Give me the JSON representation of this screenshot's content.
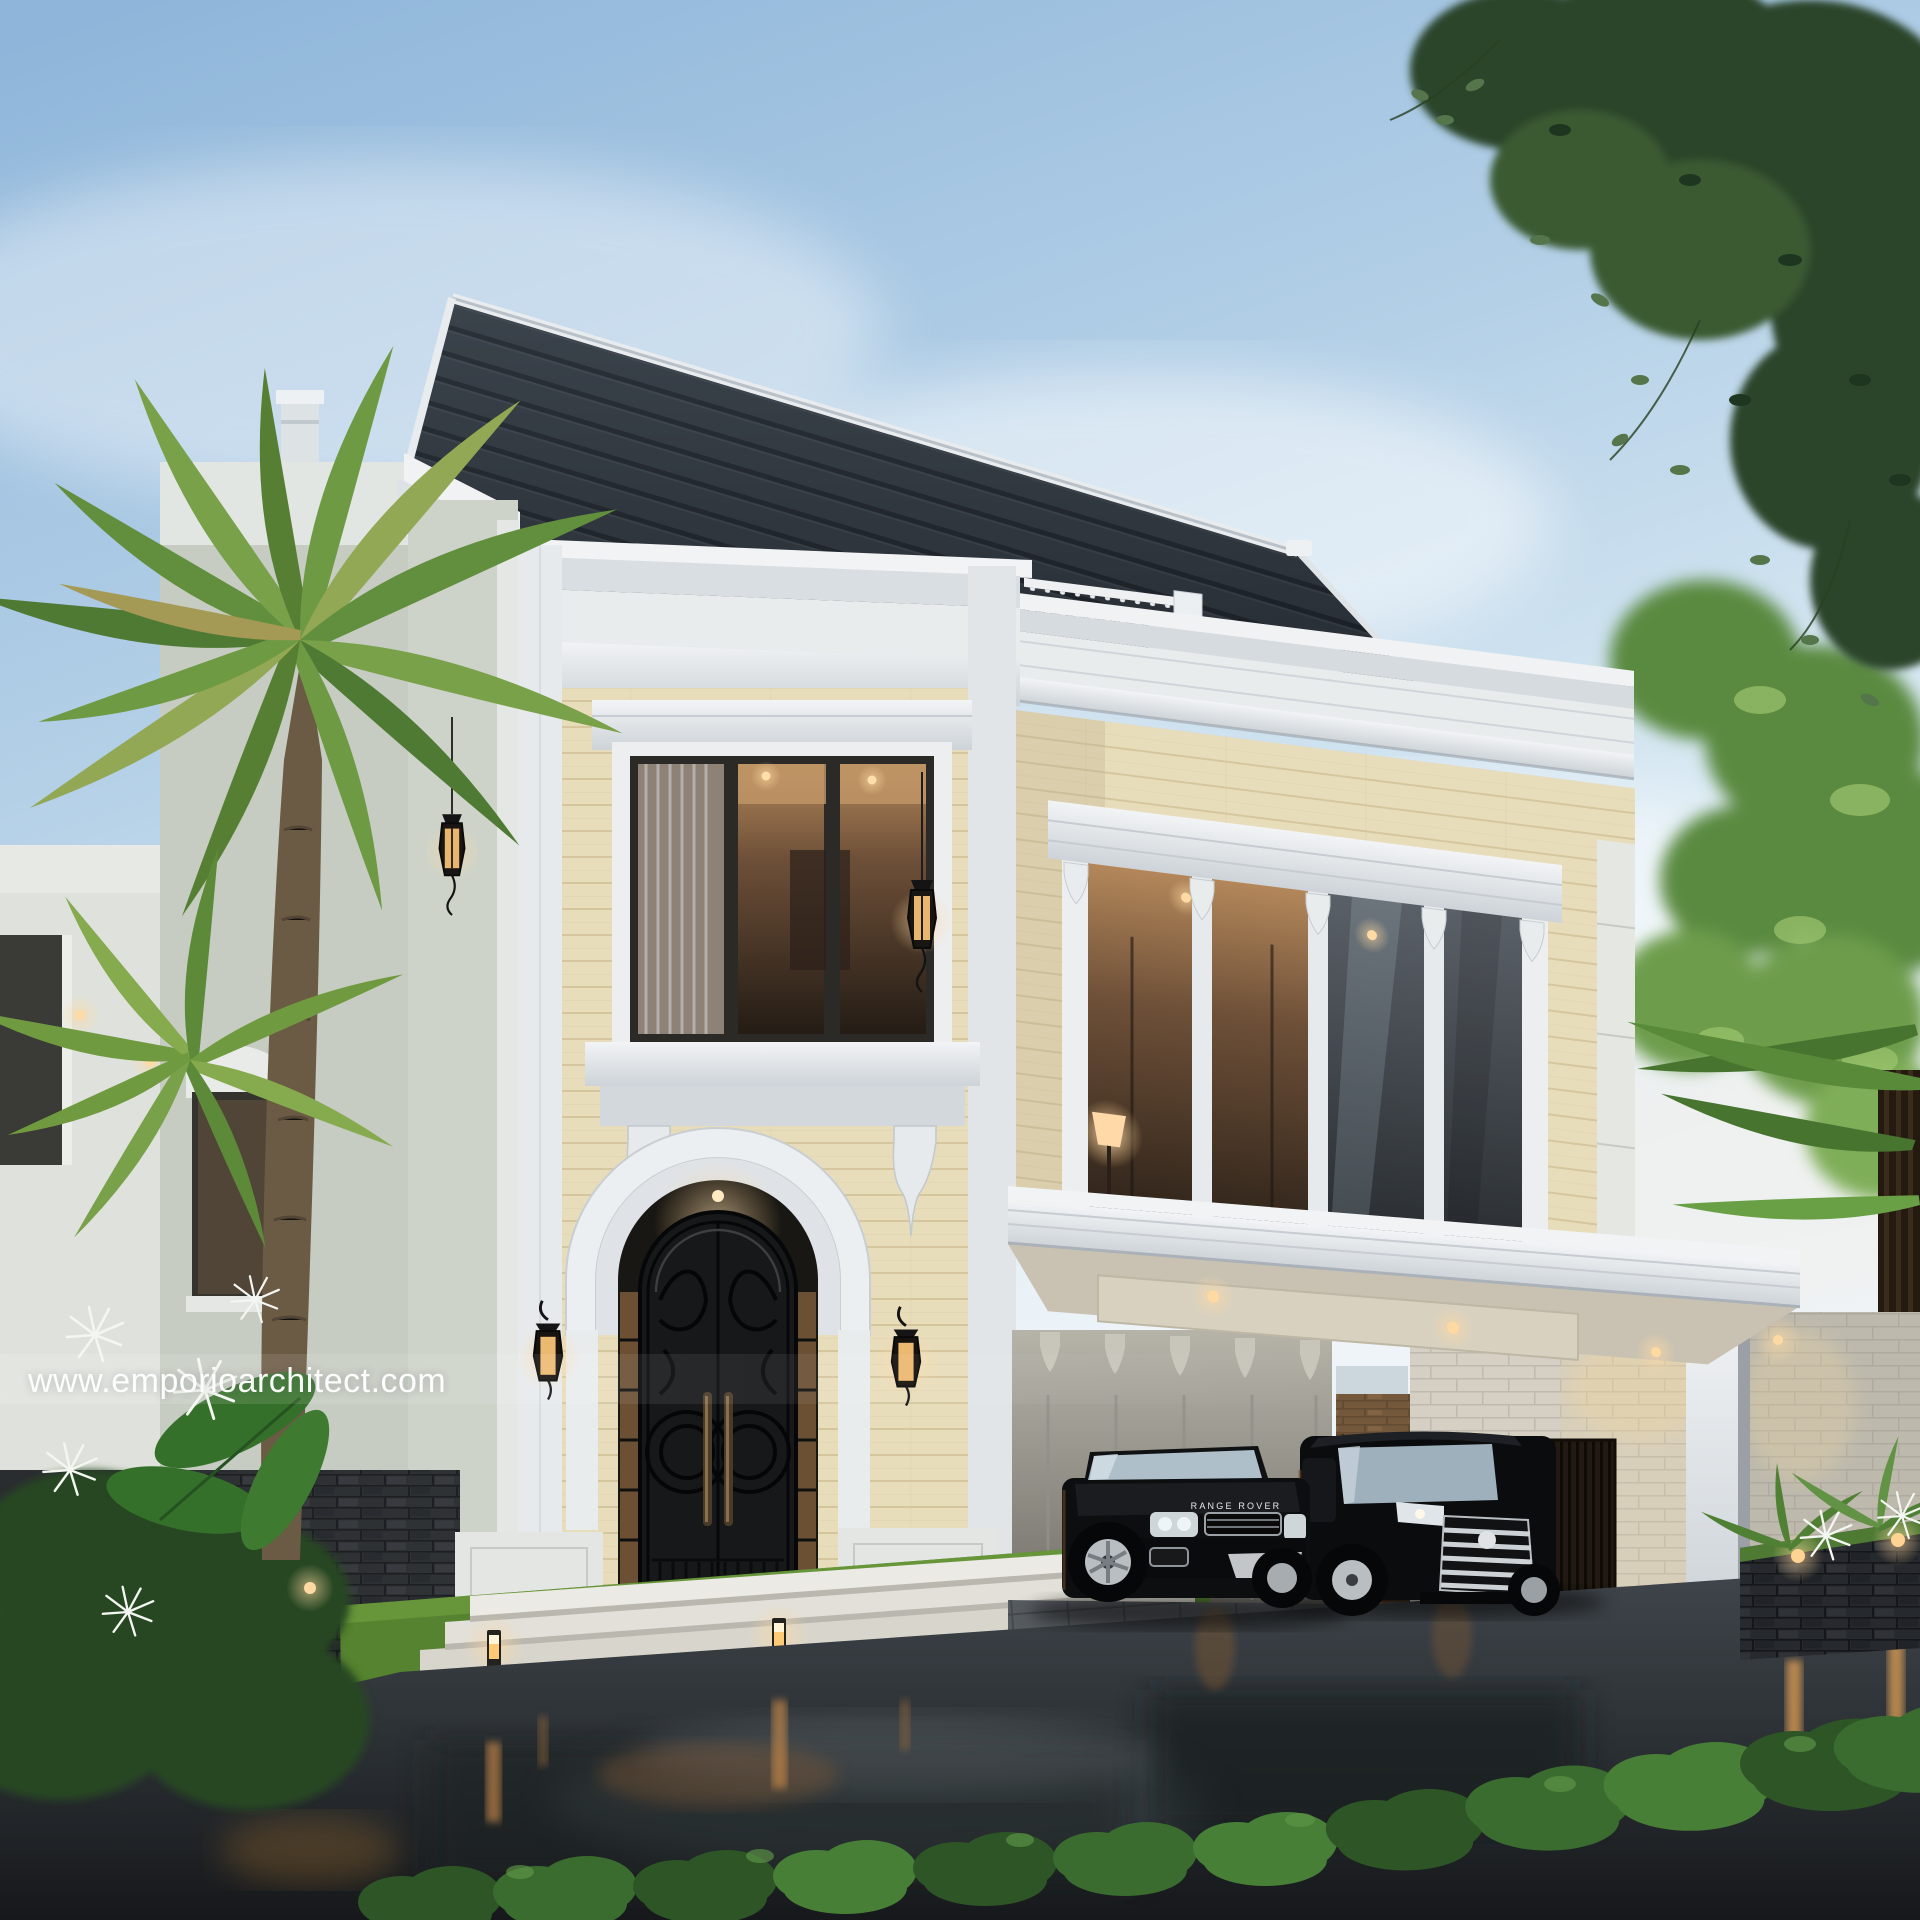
{
  "watermark": {
    "text": "www.emporioarchitect.com"
  },
  "vehicles": {
    "suv": {
      "badge": "RANGE ROVER",
      "body_color": "#0d0e10"
    },
    "mpv": {
      "body_color": "#0b0c0e"
    }
  },
  "palette": {
    "sky_top": "#8fb6da",
    "sky_horizon": "#ecf3f8",
    "roof_dark": "#333a42",
    "trim_white": "#e9eced",
    "travertine_wall": "#e8ddbb",
    "side_wall_sage": "#cdd3c9",
    "iron_door": "#17181a",
    "warm_light": "#ffca75",
    "grass_green": "#5d8a38",
    "foliage_dark": "#2c452a",
    "foliage_bright": "#6d9d4c",
    "wet_asphalt": "#34393e",
    "basalt_stone": "#26292d",
    "brown_stone": "#5f462e",
    "limestone_block": "#d5d0c3"
  }
}
